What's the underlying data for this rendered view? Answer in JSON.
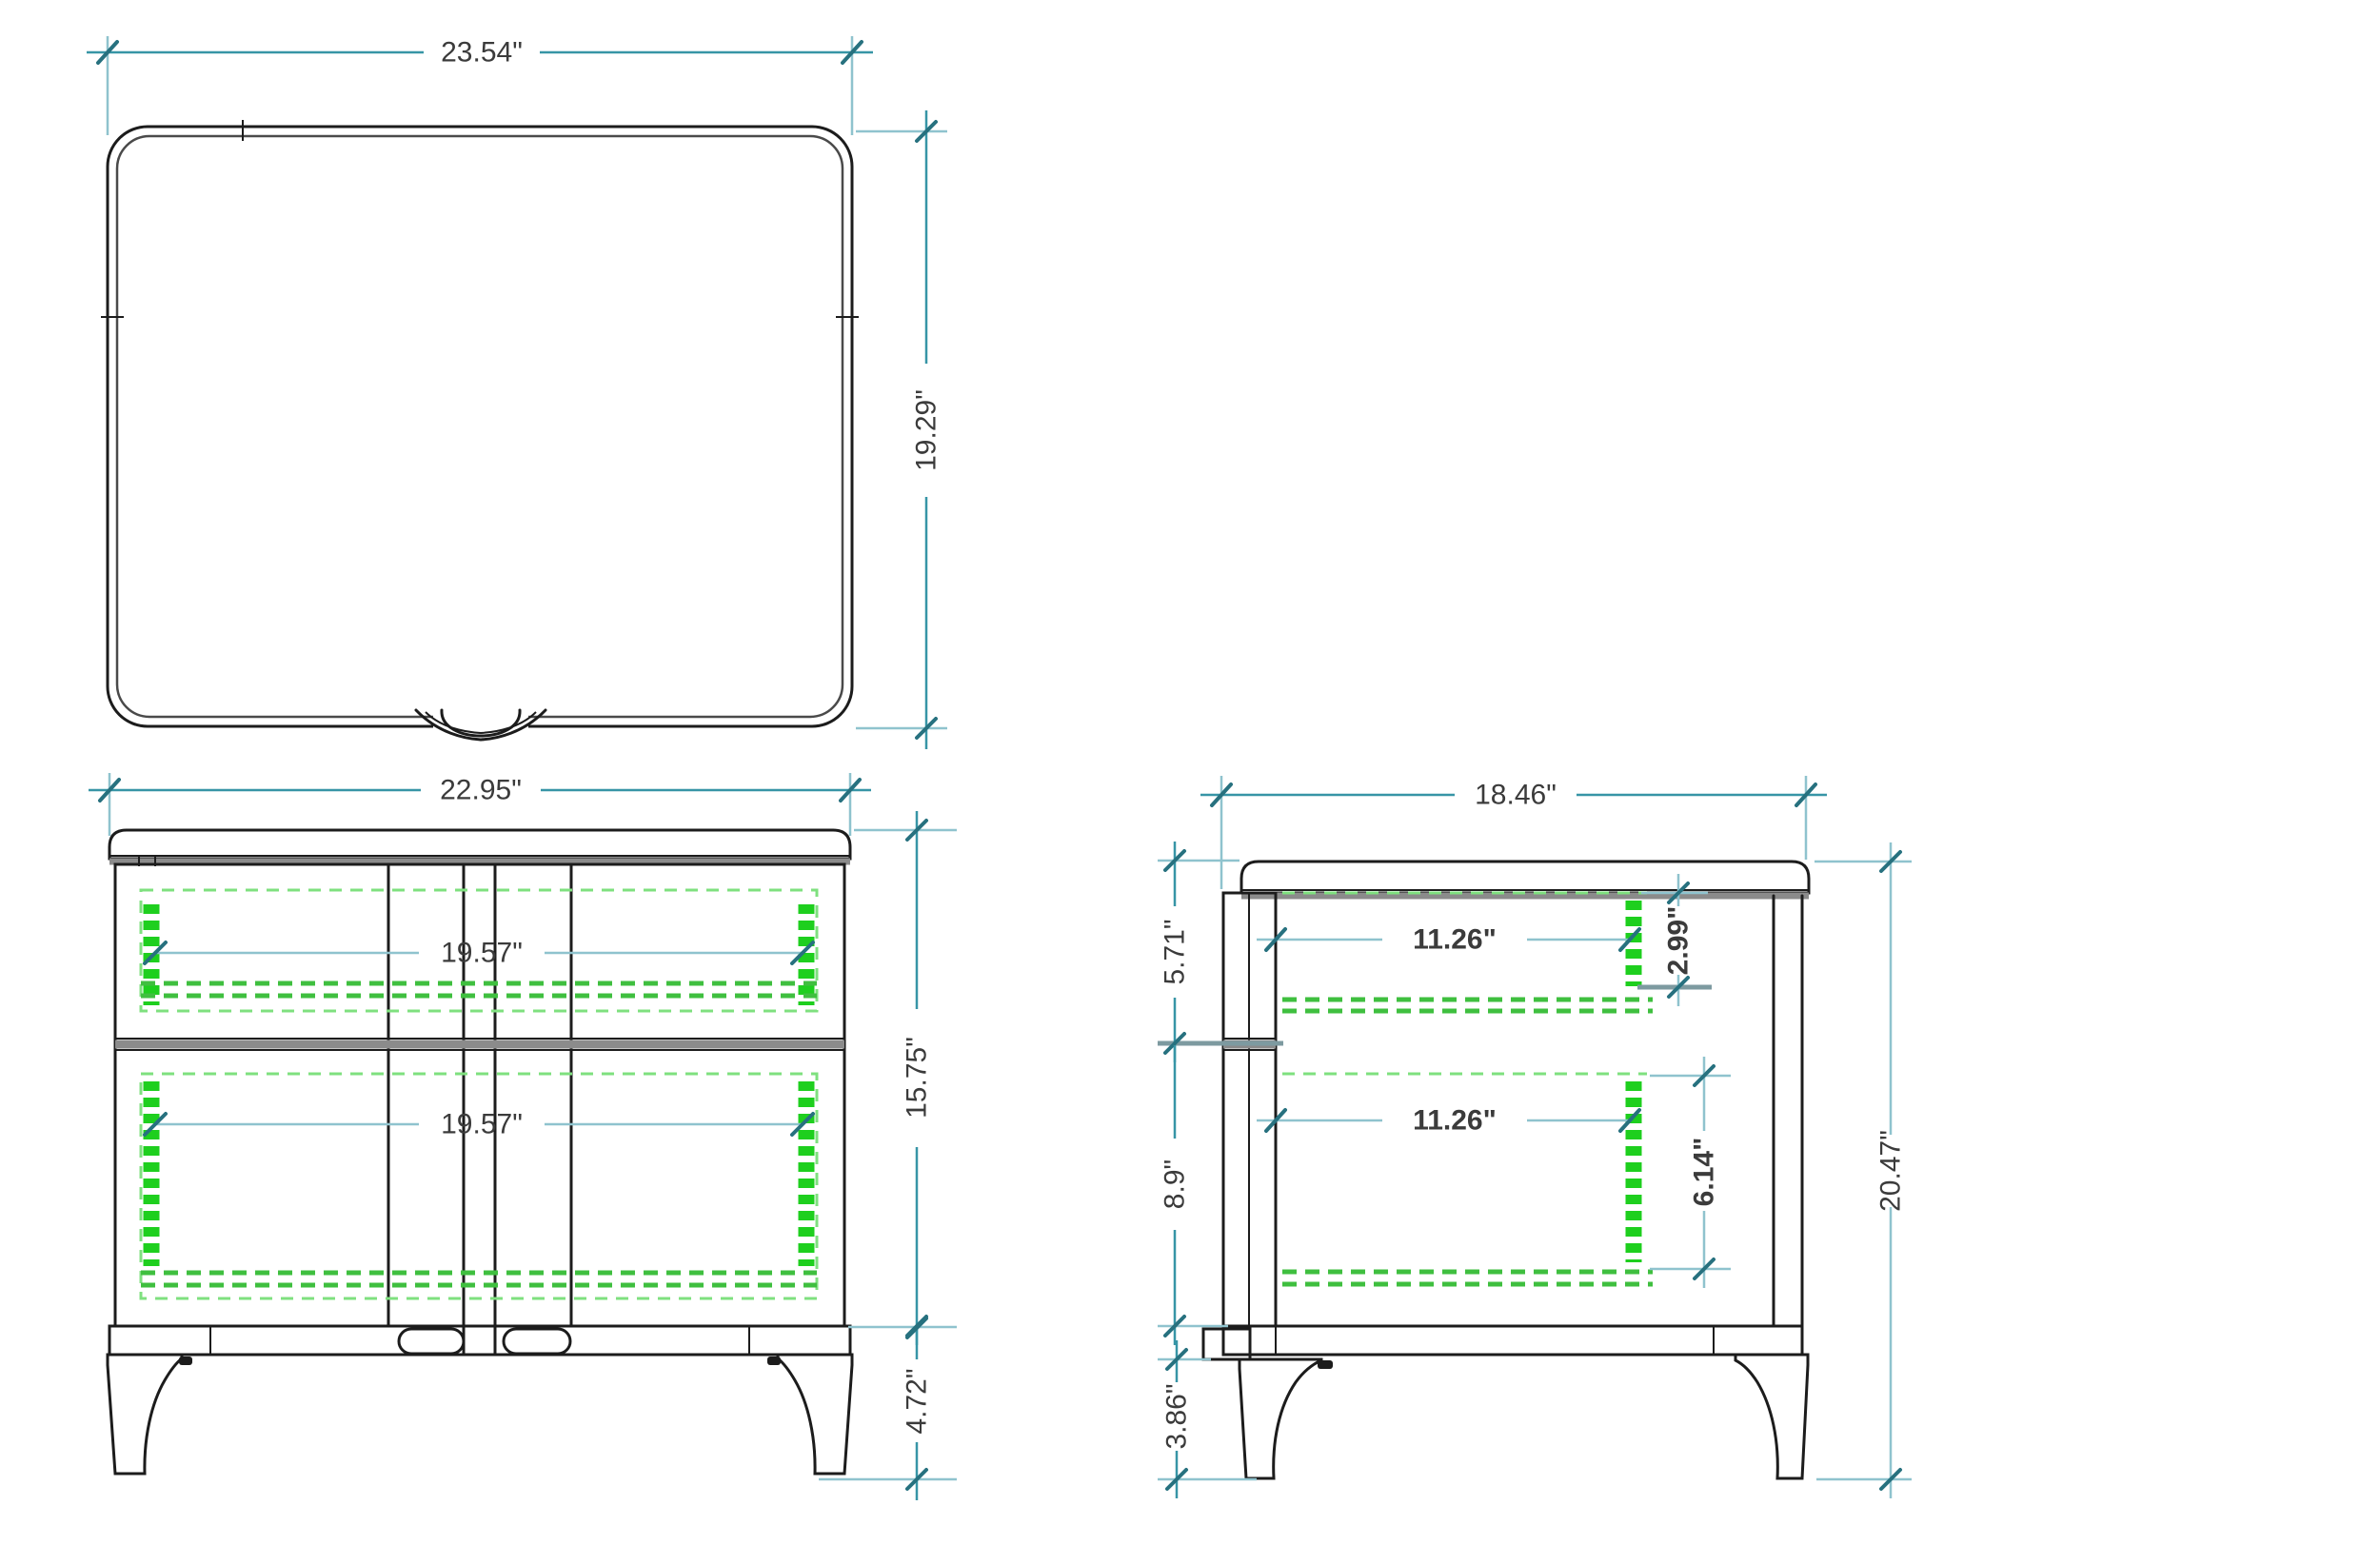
{
  "drawing": {
    "type": "furniture-three-view-dimensioned-drawing",
    "colors": {
      "outline": "#1c1c1c",
      "outline_gray": "#8b8b8b",
      "dimension_teal": "#3795a6",
      "dimension_teal_light": "#8fc3ce",
      "hidden_green_bright": "#1ecf1e",
      "hidden_green_mid": "#3fbf3f",
      "hidden_green_light": "#7fe07f",
      "label_text": "#3b3b3b",
      "background": "#ffffff"
    }
  },
  "views": {
    "top": {
      "name": "top view",
      "label_width": "23.54\"",
      "label_depth": "19.29\""
    },
    "front": {
      "name": "front view",
      "label_width": "22.95\"",
      "label_drawer_upper": "19.57\"",
      "label_drawer_lower": "19.57\"",
      "label_body_height": "15.75\"",
      "label_leg_height": "4.72\""
    },
    "side": {
      "name": "side view",
      "label_depth": "18.46\"",
      "label_drawer_upper": "11.26\"",
      "label_drawer_lower": "11.26\"",
      "label_upper_section": "5.71\"",
      "label_lower_section": "8.9\"",
      "label_pull_upper": "2.99\"",
      "label_pull_lower": "6.14\"",
      "label_total_height": "20.47\"",
      "label_leg_height": "3.86\""
    }
  }
}
